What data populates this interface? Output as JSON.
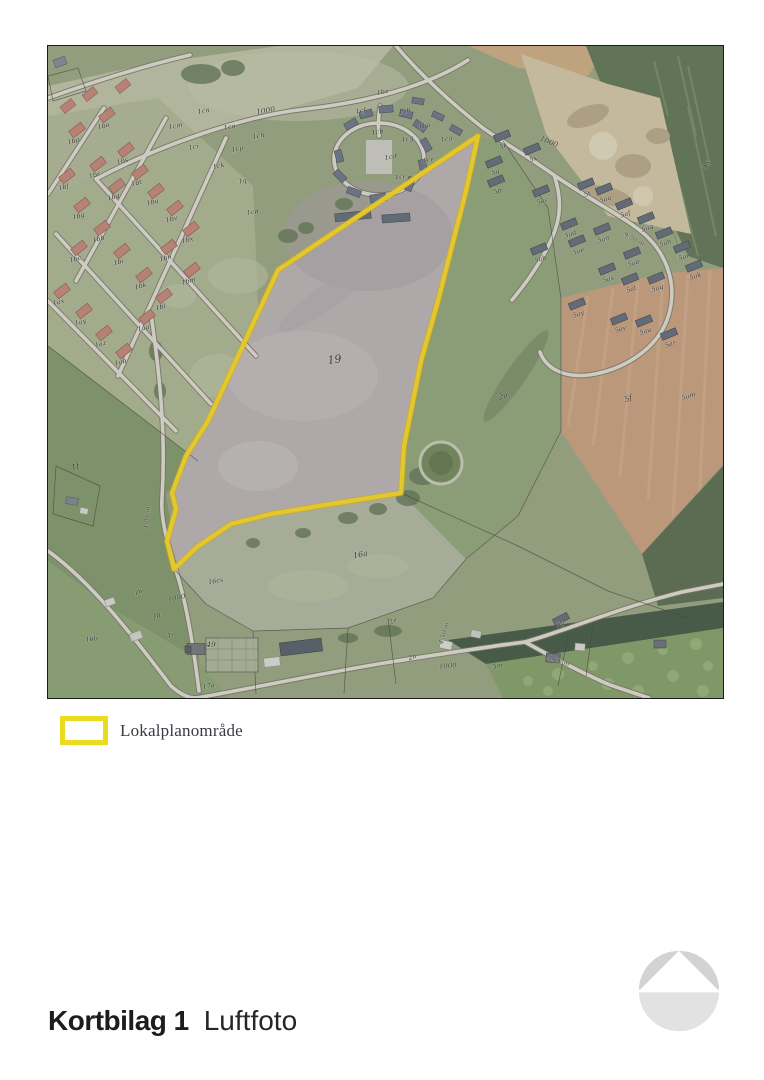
{
  "map": {
    "boundary_color": "#f2d31f",
    "colors": {
      "legend_swatch": "#ecdc1f",
      "house_left": "#bf8173",
      "house_left_edge": "#8a5247",
      "house_right": "#5d6675",
      "house_right_edge": "#353c47"
    },
    "labels": [
      {
        "t": "19",
        "x": 287,
        "y": 317,
        "s": 11,
        "r": -8,
        "g": "field"
      },
      {
        "t": "2a",
        "x": 456,
        "y": 352,
        "s": 8,
        "r": -25,
        "g": "field"
      },
      {
        "t": "5f",
        "x": 581,
        "y": 355,
        "s": 8,
        "r": -20,
        "g": "field"
      },
      {
        "t": "16a",
        "x": 313,
        "y": 511,
        "s": 8,
        "r": -12,
        "g": "field"
      },
      {
        "t": "1f",
        "x": 28,
        "y": 423,
        "s": 8,
        "r": -15,
        "g": "field"
      },
      {
        "t": "5s",
        "x": 660,
        "y": 120,
        "s": 8,
        "r": -60,
        "g": "field"
      },
      {
        "t": "16cs",
        "x": 168,
        "y": 537,
        "s": 6.5,
        "r": -10,
        "g": "field"
      },
      {
        "t": "16b",
        "x": 44,
        "y": 595,
        "s": 6.5,
        "r": -8,
        "g": "field"
      },
      {
        "t": "1h",
        "x": 91,
        "y": 548,
        "s": 6.5,
        "r": -20,
        "g": "field"
      },
      {
        "t": "48",
        "x": 109,
        "y": 572,
        "s": 6.5,
        "r": -10,
        "g": "field"
      },
      {
        "t": "1i",
        "x": 123,
        "y": 591,
        "s": 6.5,
        "r": -20,
        "g": "field"
      },
      {
        "t": "49",
        "x": 163,
        "y": 601,
        "s": 7.5,
        "r": 0,
        "g": "field"
      },
      {
        "t": "17a",
        "x": 161,
        "y": 642,
        "s": 6.5,
        "r": -10,
        "g": "field"
      },
      {
        "t": "2e",
        "x": 346,
        "y": 577,
        "s": 6.5,
        "r": -25,
        "g": "field"
      },
      {
        "t": "2h",
        "x": 365,
        "y": 613,
        "s": 6.5,
        "r": -20,
        "g": "field"
      },
      {
        "t": "5g",
        "x": 513,
        "y": 580,
        "s": 6.5,
        "r": -20,
        "g": "field"
      },
      {
        "t": "5m",
        "x": 450,
        "y": 622,
        "s": 6.5,
        "r": -10,
        "g": "field"
      },
      {
        "t": "5am",
        "x": 641,
        "y": 352,
        "s": 6.5,
        "r": -15,
        "g": "field"
      },
      {
        "t": "1000",
        "x": 218,
        "y": 67,
        "s": 7.5,
        "r": -10,
        "g": "road"
      },
      {
        "t": "1000",
        "x": 500,
        "y": 98,
        "s": 7.5,
        "r": 22,
        "g": "road"
      },
      {
        "t": "1000",
        "x": 129,
        "y": 554,
        "s": 7,
        "r": -12,
        "g": "road"
      },
      {
        "t": "1000",
        "x": 400,
        "y": 622,
        "s": 7,
        "r": -5,
        "g": "road"
      },
      {
        "t": "4.00 m",
        "x": 101,
        "y": 472,
        "s": 6.5,
        "r": -82,
        "g": "measure"
      },
      {
        "t": "4.00 m",
        "x": 510,
        "y": 617,
        "s": 6.5,
        "r": 18,
        "g": "measure"
      },
      {
        "t": "4.50 m",
        "x": 398,
        "y": 588,
        "s": 6.5,
        "r": -72,
        "g": "measure"
      },
      {
        "t": "9.50 m",
        "x": 585,
        "y": 195,
        "s": 6.5,
        "r": 28,
        "g": "measure"
      },
      {
        "t": "1bo",
        "x": 56,
        "y": 82,
        "s": 6.5,
        "r": -15,
        "g": "left-res"
      },
      {
        "t": "1bp",
        "x": 26,
        "y": 97,
        "s": 6.5,
        "r": -15,
        "g": "left-res"
      },
      {
        "t": "1bs",
        "x": 75,
        "y": 117,
        "s": 6.5,
        "r": -15,
        "g": "left-res"
      },
      {
        "t": "1br",
        "x": 47,
        "y": 131,
        "s": 6.5,
        "r": -15,
        "g": "left-res"
      },
      {
        "t": "1bt",
        "x": 89,
        "y": 139,
        "s": 6.5,
        "r": -15,
        "g": "left-res"
      },
      {
        "t": "1bf",
        "x": 16,
        "y": 143,
        "s": 6.5,
        "r": -15,
        "g": "left-res"
      },
      {
        "t": "1bq",
        "x": 66,
        "y": 153,
        "s": 6.5,
        "r": -15,
        "g": "left-res"
      },
      {
        "t": "1bu",
        "x": 105,
        "y": 158,
        "s": 6.5,
        "r": -15,
        "g": "left-res"
      },
      {
        "t": "1bg",
        "x": 31,
        "y": 172,
        "s": 6.5,
        "r": -15,
        "g": "left-res"
      },
      {
        "t": "1bv",
        "x": 124,
        "y": 175,
        "s": 6.5,
        "r": -15,
        "g": "left-res"
      },
      {
        "t": "1bb",
        "x": 51,
        "y": 195,
        "s": 6.5,
        "r": -15,
        "g": "left-res"
      },
      {
        "t": "1bx",
        "x": 140,
        "y": 196,
        "s": 6.5,
        "r": -15,
        "g": "left-res"
      },
      {
        "t": "1bc",
        "x": 28,
        "y": 215,
        "s": 6.5,
        "r": -15,
        "g": "left-res"
      },
      {
        "t": "1bi",
        "x": 71,
        "y": 218,
        "s": 6.5,
        "r": -15,
        "g": "left-res"
      },
      {
        "t": "1bn",
        "x": 118,
        "y": 214,
        "s": 6.5,
        "r": -15,
        "g": "left-res"
      },
      {
        "t": "1bk",
        "x": 93,
        "y": 242,
        "s": 6.5,
        "r": -15,
        "g": "left-res"
      },
      {
        "t": "1bm",
        "x": 141,
        "y": 237,
        "s": 6.5,
        "r": -15,
        "g": "left-res"
      },
      {
        "t": "1ax",
        "x": 11,
        "y": 258,
        "s": 6.5,
        "r": -15,
        "g": "left-res"
      },
      {
        "t": "1bl",
        "x": 113,
        "y": 263,
        "s": 6.5,
        "r": -15,
        "g": "left-res"
      },
      {
        "t": "1ay",
        "x": 33,
        "y": 278,
        "s": 6.5,
        "r": -15,
        "g": "left-res"
      },
      {
        "t": "1aa",
        "x": 96,
        "y": 284,
        "s": 6.5,
        "r": -15,
        "g": "left-res"
      },
      {
        "t": "1az",
        "x": 53,
        "y": 300,
        "s": 6.5,
        "r": -15,
        "g": "left-res"
      },
      {
        "t": "1ab",
        "x": 73,
        "y": 318,
        "s": 6.5,
        "r": -15,
        "g": "left-res"
      },
      {
        "t": "1cn",
        "x": 156,
        "y": 67,
        "s": 6.5,
        "r": -12,
        "g": "mid-res"
      },
      {
        "t": "1cm",
        "x": 128,
        "y": 82,
        "s": 6.5,
        "r": -12,
        "g": "mid-res"
      },
      {
        "t": "1co",
        "x": 182,
        "y": 83,
        "s": 6.5,
        "r": -12,
        "g": "mid-res"
      },
      {
        "t": "1ch",
        "x": 211,
        "y": 92,
        "s": 6.5,
        "r": -12,
        "g": "mid-res"
      },
      {
        "t": "1ci",
        "x": 146,
        "y": 103,
        "s": 6.5,
        "r": -12,
        "g": "mid-res"
      },
      {
        "t": "1cp",
        "x": 190,
        "y": 105,
        "s": 6.5,
        "r": -12,
        "g": "mid-res"
      },
      {
        "t": "1ck",
        "x": 171,
        "y": 122,
        "s": 6.5,
        "r": -12,
        "g": "mid-res"
      },
      {
        "t": "1q",
        "x": 195,
        "y": 137,
        "s": 6.5,
        "r": -12,
        "g": "mid-res"
      },
      {
        "t": "1cø",
        "x": 205,
        "y": 168,
        "s": 6.5,
        "r": -12,
        "g": "mid-res"
      },
      {
        "t": "1bz",
        "x": 335,
        "y": 48,
        "s": 6.5,
        "r": -12,
        "g": "mid-res"
      },
      {
        "t": "1cf",
        "x": 313,
        "y": 67,
        "s": 6.5,
        "r": -12,
        "g": "mid-res"
      },
      {
        "t": "1ab",
        "x": 357,
        "y": 67,
        "s": 6.5,
        "r": -12,
        "g": "mid-res"
      },
      {
        "t": "1ba",
        "x": 377,
        "y": 82,
        "s": 6.5,
        "r": -12,
        "g": "mid-res"
      },
      {
        "t": "1cb",
        "x": 330,
        "y": 88,
        "s": 6.5,
        "r": -12,
        "g": "mid-res"
      },
      {
        "t": "1cg",
        "x": 360,
        "y": 95,
        "s": 6.5,
        "r": -12,
        "g": "mid-res"
      },
      {
        "t": "1ca",
        "x": 399,
        "y": 95,
        "s": 6.5,
        "r": -12,
        "g": "mid-res"
      },
      {
        "t": "1cd",
        "x": 343,
        "y": 113,
        "s": 6.5,
        "r": -12,
        "g": "mid-res"
      },
      {
        "t": "1ce",
        "x": 381,
        "y": 116,
        "s": 6.5,
        "r": -12,
        "g": "mid-res"
      },
      {
        "t": "1cc",
        "x": 353,
        "y": 133,
        "s": 6.5,
        "r": -12,
        "g": "mid-res"
      },
      {
        "t": "5k",
        "x": 456,
        "y": 102,
        "s": 6.5,
        "r": -18,
        "g": "right-res"
      },
      {
        "t": "5x",
        "x": 486,
        "y": 115,
        "s": 6.5,
        "r": -18,
        "g": "right-res"
      },
      {
        "t": "5q",
        "x": 448,
        "y": 128,
        "s": 6.5,
        "r": -18,
        "g": "right-res"
      },
      {
        "t": "5p",
        "x": 450,
        "y": 147,
        "s": 6.5,
        "r": -18,
        "g": "right-res"
      },
      {
        "t": "5ac",
        "x": 495,
        "y": 157,
        "s": 6.5,
        "r": -18,
        "g": "right-res"
      },
      {
        "t": "5t",
        "x": 540,
        "y": 150,
        "s": 6.5,
        "r": -18,
        "g": "right-res"
      },
      {
        "t": "5aa",
        "x": 558,
        "y": 155,
        "s": 6.5,
        "r": -18,
        "g": "right-res"
      },
      {
        "t": "5af",
        "x": 578,
        "y": 170,
        "s": 6.5,
        "r": -18,
        "g": "right-res"
      },
      {
        "t": "5ag",
        "x": 600,
        "y": 184,
        "s": 6.5,
        "r": -18,
        "g": "right-res"
      },
      {
        "t": "5an",
        "x": 556,
        "y": 195,
        "s": 6.5,
        "r": -18,
        "g": "right-res"
      },
      {
        "t": "5ah",
        "x": 618,
        "y": 199,
        "s": 6.5,
        "r": -18,
        "g": "right-res"
      },
      {
        "t": "5ad",
        "x": 523,
        "y": 190,
        "s": 6.5,
        "r": -18,
        "g": "right-res"
      },
      {
        "t": "5ae",
        "x": 531,
        "y": 207,
        "s": 6.5,
        "r": -18,
        "g": "right-res"
      },
      {
        "t": "5ai",
        "x": 636,
        "y": 213,
        "s": 6.5,
        "r": -18,
        "g": "right-res"
      },
      {
        "t": "5ab",
        "x": 493,
        "y": 215,
        "s": 6.5,
        "r": -18,
        "g": "right-res"
      },
      {
        "t": "5ao",
        "x": 586,
        "y": 219,
        "s": 6.5,
        "r": -18,
        "g": "right-res"
      },
      {
        "t": "5ak",
        "x": 648,
        "y": 232,
        "s": 6.5,
        "r": -18,
        "g": "right-res"
      },
      {
        "t": "5as",
        "x": 561,
        "y": 235,
        "s": 6.5,
        "r": -18,
        "g": "right-res"
      },
      {
        "t": "5at",
        "x": 584,
        "y": 245,
        "s": 6.5,
        "r": -18,
        "g": "right-res"
      },
      {
        "t": "5aq",
        "x": 610,
        "y": 244,
        "s": 6.5,
        "r": -18,
        "g": "right-res"
      },
      {
        "t": "5ay",
        "x": 531,
        "y": 270,
        "s": 6.5,
        "r": -18,
        "g": "right-res"
      },
      {
        "t": "5av",
        "x": 573,
        "y": 285,
        "s": 6.5,
        "r": -18,
        "g": "right-res"
      },
      {
        "t": "5au",
        "x": 598,
        "y": 287,
        "s": 6.5,
        "r": -18,
        "g": "right-res"
      },
      {
        "t": "5ar",
        "x": 623,
        "y": 300,
        "s": 6.5,
        "r": -18,
        "g": "right-res"
      }
    ]
  },
  "legend": {
    "items": [
      {
        "label": "Lokalplanområde"
      }
    ]
  },
  "footer": {
    "doc_title": "Kortbilag 1",
    "doc_subtitle": "Luftfoto"
  }
}
